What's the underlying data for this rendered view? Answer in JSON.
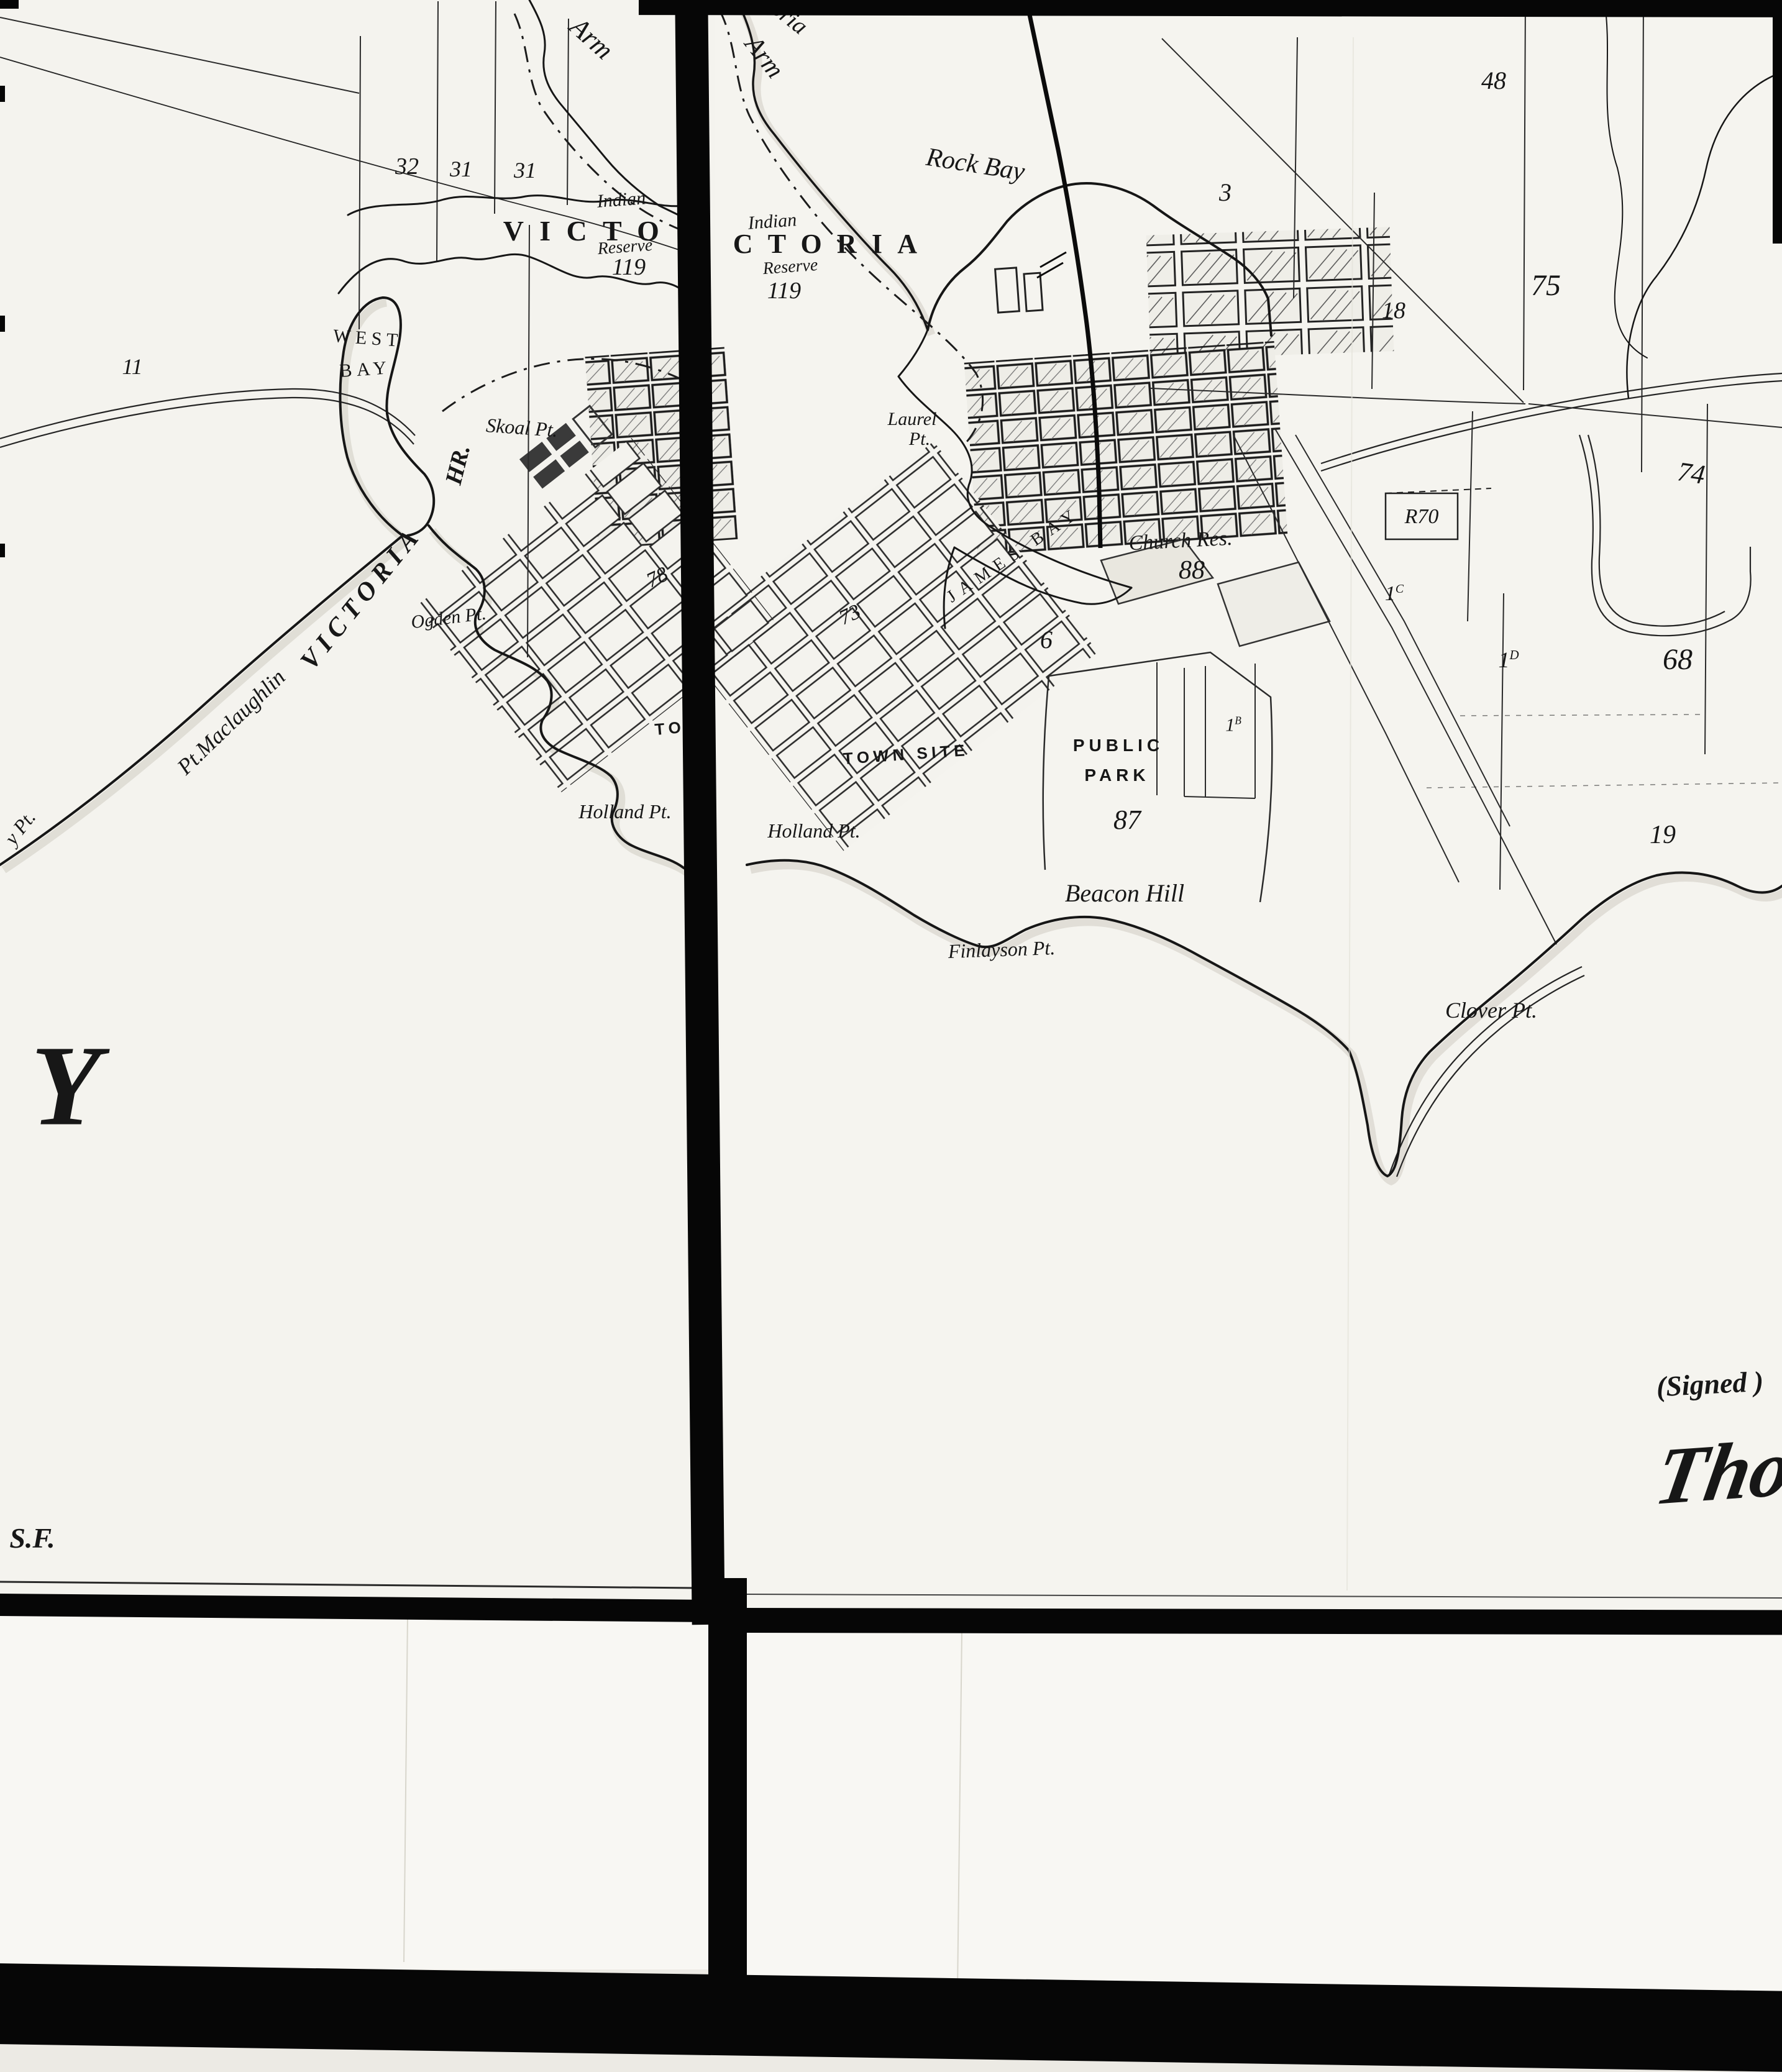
{
  "sheet_left": {
    "arm": "Arm",
    "section_32": "32",
    "section_31a": "31",
    "section_31b": "31",
    "section_11": "11",
    "victoria_clipped": "VICTO",
    "indian": "Indian",
    "reserve": "Reserve",
    "reserve_number": "119",
    "west": "WEST",
    "bay": "BAY",
    "skoal_pt": "Skoal Pt.",
    "harbour_hr": "HR.",
    "victoria_harbour": "VICTORIA",
    "pt_maclaughlin": "Pt.Maclaughlin",
    "edge_pt_fragment": "y Pt.",
    "ogden_pt": "Ogden Pt.",
    "section_78": "78",
    "town_site_clipped": "TO",
    "holland_pt": "Holland Pt.",
    "big_letter_y": "Y",
    "initials_sf": "S.F."
  },
  "sheet_right": {
    "victoria_arm_fragment": "oria",
    "arm": "Arm",
    "rock_bay": "Rock Bay",
    "indian": "Indian",
    "victoria_clipped": "CTORIA",
    "reserve": "Reserve",
    "reserve_number": "119",
    "section_3": "3",
    "section_48": "48",
    "section_18": "18",
    "section_75": "75",
    "section_74": "74",
    "reserve_r70": "R70",
    "lot_1c_base": "1",
    "lot_1c_sup": "C",
    "lot_1b_base": "1",
    "lot_1b_sup": "B",
    "lot_1d_base": "1",
    "lot_1d_sup": "D",
    "laurel_pt_line1": "Laurel",
    "laurel_pt_line2": "Pt.",
    "james_bay": "JAMES BAY",
    "church_res": "Church Res.",
    "section_88": "88",
    "section_6": "6",
    "section_73": "73",
    "town_site": "TOWN SITE",
    "public": "PUBLIC",
    "park": "PARK",
    "section_87": "87",
    "beacon_hill": "Beacon Hill",
    "section_68": "68",
    "section_19": "19",
    "holland_pt": "Holland Pt.",
    "finlayson_pt": "Finlayson Pt.",
    "clover_pt": "Clover Pt.",
    "signed": "(Signed )",
    "signature": "Thos"
  },
  "ink_color": "#1c1c1c",
  "paper_color": "#f5f4ef"
}
